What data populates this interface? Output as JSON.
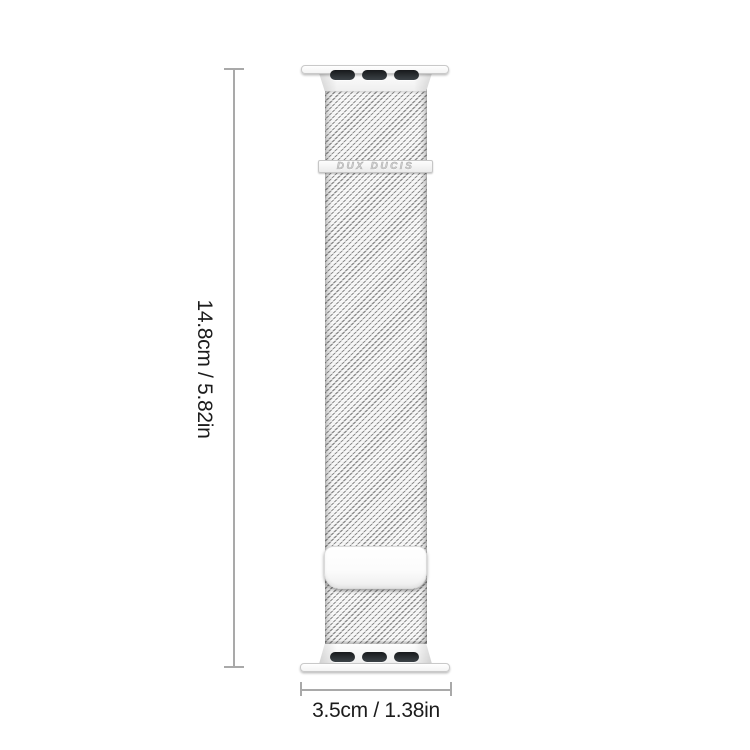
{
  "canvas": {
    "width": 750,
    "height": 750,
    "background": "#ffffff"
  },
  "product": {
    "type": "watch-band",
    "style": "milanese-mesh-loop",
    "finish": "silver",
    "brand_engraving": "DUX DUCIS"
  },
  "annotations": {
    "height": {
      "label": "14.8cm / 5.82in",
      "orientation": "vertical",
      "marker_style": "line-with-end-caps"
    },
    "width": {
      "label": "3.5cm / 1.38in",
      "orientation": "horizontal",
      "marker_style": "line-with-end-caps"
    }
  },
  "colors": {
    "dimension_line": "#a9a9a9",
    "label_text": "#1c1c1c",
    "mesh_dark": "#8f8f8f",
    "mesh_light": "#f4f4f4",
    "slot_dark": "#17191b",
    "hardware_border": "#c9c9c9",
    "brand_text": "#d4d4d4"
  }
}
